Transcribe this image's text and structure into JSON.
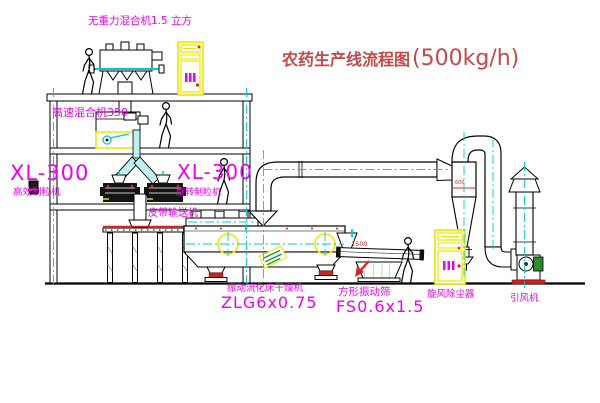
{
  "diagram": {
    "title": {
      "text": "农药生产线流程图",
      "capacity": "(500kg/h)"
    },
    "equipment_labels": {
      "gravity_mixer": "无重力混合机1.5 立方",
      "high_speed_mixer": "高速混合机350",
      "granulator_left_model": "XL-300",
      "granulator_left_name": "高效制粒机",
      "granulator_right_model": "XL-300",
      "granulator_right_name": "旋转制粒机",
      "belt_conveyor": "皮带输送机",
      "fluid_bed_dryer_name": "振动流化床干燥机",
      "fluid_bed_dryer_model": "ZLG6x0.75",
      "square_sieve_name": "方形振动筛",
      "square_sieve_model": "FS0.6x1.5",
      "cyclone": "旋风除尘器",
      "fan": "引风机"
    },
    "dimensions": {
      "sieve_length": "1500",
      "cyclone_size": "600"
    },
    "colors": {
      "label_magenta": "#f000f0",
      "title_red": "#c64848",
      "dimension_red": "#dd2222",
      "centerline_cyan": "#00cccc",
      "cabinet_yellow": "#e8e800",
      "motor_green": "#2e8b2e"
    }
  }
}
